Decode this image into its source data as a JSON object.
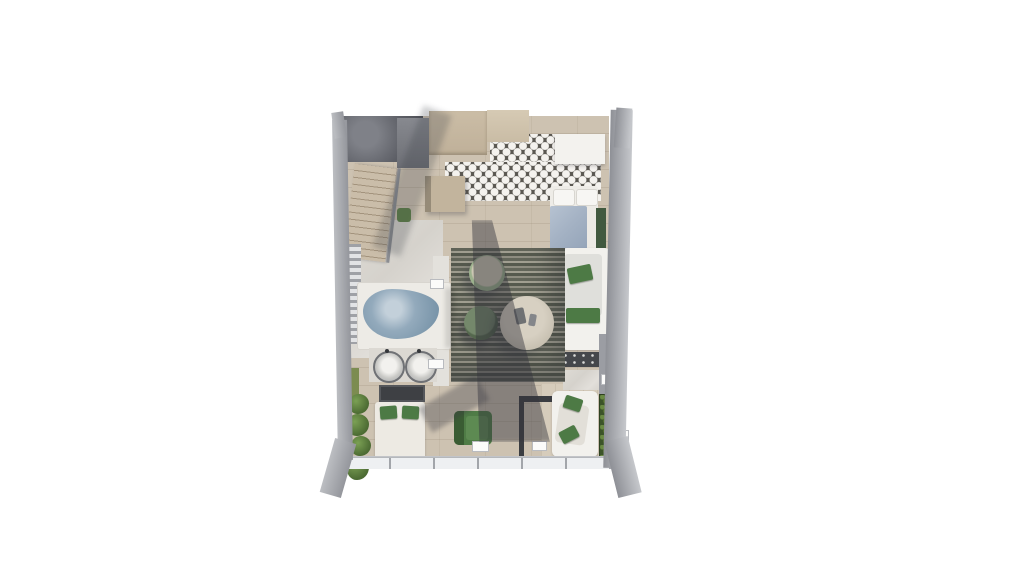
{
  "scene": {
    "type": "3d-top-view-floorplan-render",
    "background_color": "#ffffff",
    "description_names": [
      "studio-apartment-floorplan"
    ]
  },
  "palette": {
    "wall_gray": "#a4a6ac",
    "wood_floor": "#cdc2b1",
    "marble": "#dedbd5",
    "hex_tile_dark": "#5a5751",
    "hex_tile_light": "#f4f2ee",
    "rug_dark": "#565a4e",
    "rug_light": "#a19f91",
    "water_blue": "#8ba3b6",
    "bedding_white": "#edeae3",
    "blanket_blue": "#aab8c9",
    "cushion_green": "#4d7a45",
    "armchair_green": "#4f7c46",
    "foliage_green": "#4c6b33",
    "console_dark": "#45474b",
    "shadow": "rgba(50,52,60,0.45)"
  },
  "labels": {
    "plan": "studio apartment top view",
    "stair_landing": "stair landing",
    "staircase": "staircase",
    "kitchen_cabinets": "kitchen cabinets",
    "appliance": "kitchen appliance",
    "peninsula": "kitchen counter",
    "hex_floor": "hexagon tile floor",
    "wardrobe": "white cabinet",
    "bed_upper": "double bed",
    "nightstand": "nightstand",
    "plant": "potted plant",
    "sofa": "sofa with green cushions",
    "console": "media console",
    "rug": "striped rug",
    "pouf": "round pouf",
    "coffee_table": "round stone coffee table",
    "bathtub": "bathtub with water",
    "vanity": "double sink vanity",
    "dark_cabinet": "dark cabinet",
    "bed_lower": "bed with green pillows",
    "armchair": "green armchair",
    "partition": "dark partition frame",
    "lounge_chair": "lounge chair",
    "hedge": "hedge planter",
    "plants_left": "plant row",
    "louver": "louver screen",
    "window_band": "window wall",
    "wall": "exterior wall"
  }
}
